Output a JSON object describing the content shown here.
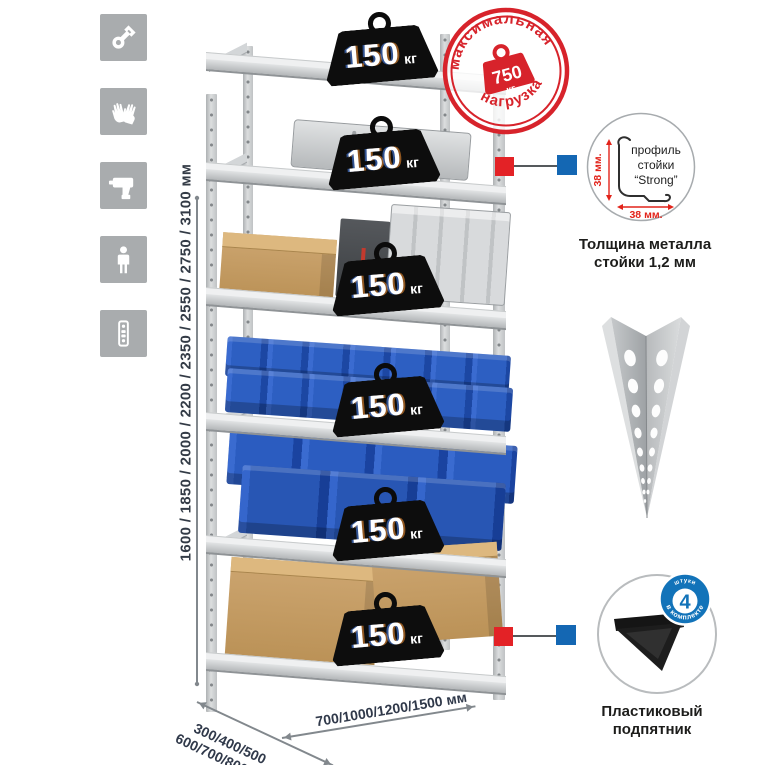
{
  "stage": {
    "bg": "#ffffff"
  },
  "sidebar": {
    "tile_color": "#a9acae",
    "icons": [
      "wrench",
      "gloves",
      "drill",
      "person",
      "perforated-profile"
    ]
  },
  "dims": {
    "height": "1600 / 1850 / 2000 / 2200 / 2350 / 2550 / 2750 / 3100 мм",
    "depth_line1": "300/400/500",
    "depth_line2": "600/700/800 мм",
    "width": "700/1000/1200/1500 мм"
  },
  "rack": {
    "badges": [
      {
        "value": "150",
        "unit": "кг"
      },
      {
        "value": "150",
        "unit": "кг"
      },
      {
        "value": "150",
        "unit": "кг"
      },
      {
        "value": "150",
        "unit": "кг"
      },
      {
        "value": "150",
        "unit": "кг"
      },
      {
        "value": "150",
        "unit": "кг"
      }
    ]
  },
  "stamp": {
    "top_text": "максимальная",
    "bottom_text": "нагрузка",
    "value": "750",
    "unit": "кг",
    "color": "#d7232b"
  },
  "profile": {
    "line1": "профиль",
    "line2": "стойки",
    "line3": "“Strong”",
    "dim_v": "38 мм.",
    "dim_h": "38 мм.",
    "caption1": "Толщина металла",
    "caption2": "стойки 1,2 мм"
  },
  "foot": {
    "caption1": "Пластиковый",
    "caption2": "подпятник",
    "badge_value": "4",
    "badge_top": "штуки",
    "badge_bottom": "в комплекте",
    "badge_color": "#1273b9"
  },
  "connectors": {
    "red": "#e32226",
    "blue": "#1467b3"
  }
}
